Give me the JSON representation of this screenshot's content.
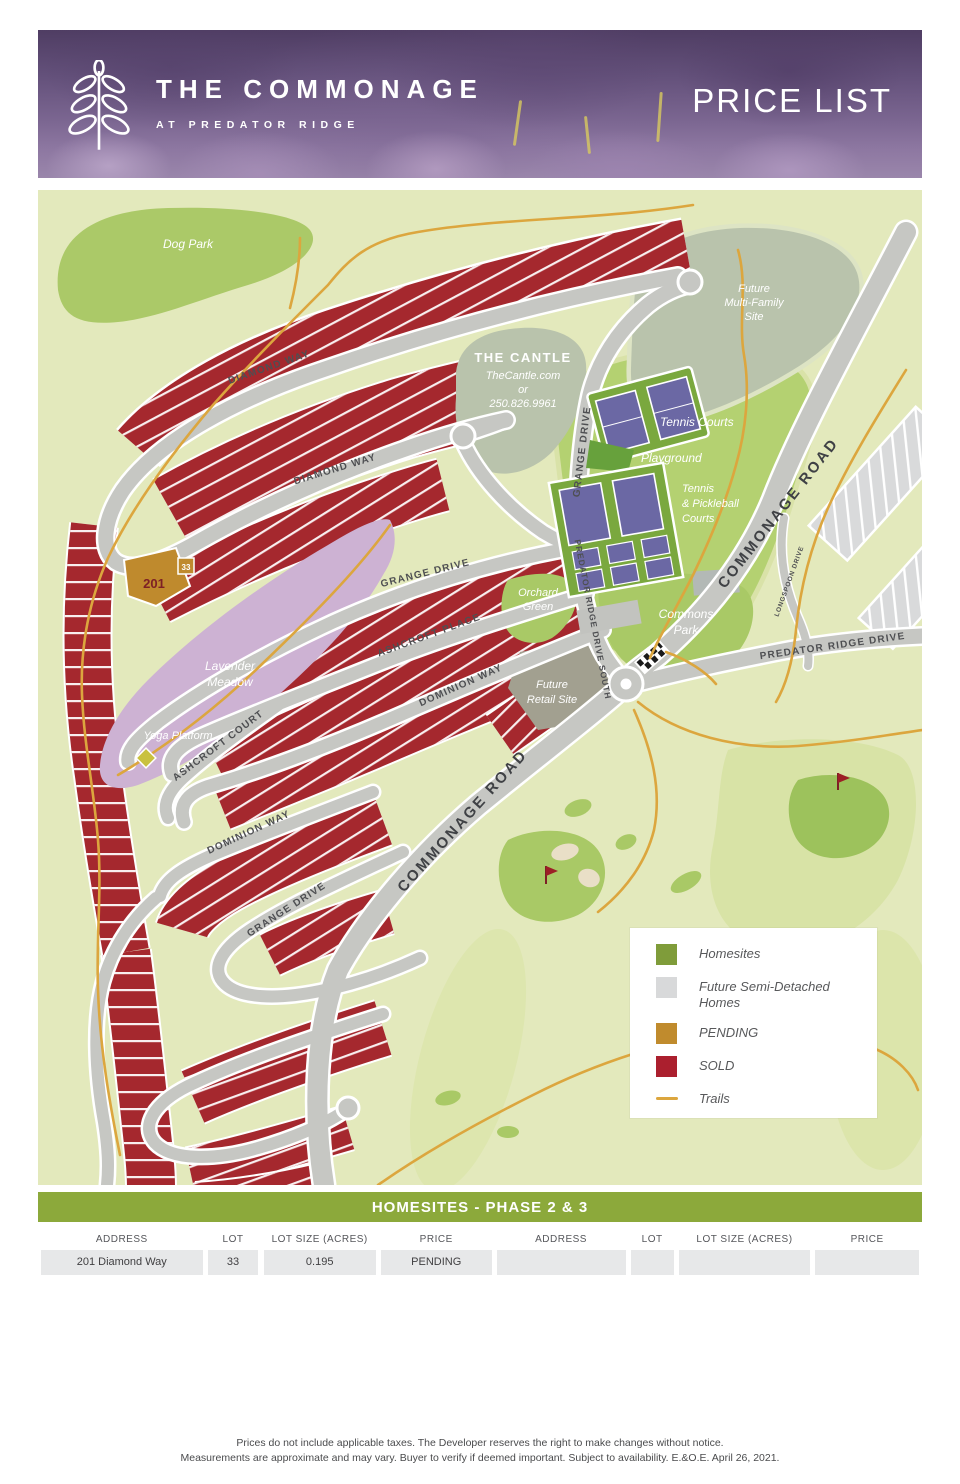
{
  "header": {
    "brand_name": "THE COMMONAGE",
    "brand_subtitle": "AT PREDATOR RIDGE",
    "page_title": "PRICE LIST"
  },
  "map": {
    "labels": {
      "dog_park": "Dog Park",
      "cantle_name": "THE CANTLE",
      "cantle_web": "TheCantle.com",
      "cantle_or": "or",
      "cantle_phone": "250.826.9961",
      "future_mf_1": "Future",
      "future_mf_2": "Multi-Family",
      "future_mf_3": "Site",
      "tennis_courts": "Tennis Courts",
      "playground": "Playground",
      "pickleball_1": "Tennis",
      "pickleball_2": "& Pickleball",
      "pickleball_3": "Courts",
      "orchard_1": "Orchard",
      "orchard_2": "Green",
      "commons_1": "Commons",
      "commons_2": "Park",
      "retail_1": "Future",
      "retail_2": "Retail Site",
      "meadow_1": "Lavender",
      "meadow_2": "Meadow",
      "yoga": "Yoga Platform",
      "lot201": "201",
      "lot201_badge": "33"
    },
    "roads": {
      "diamond_way": "DIAMOND WAY",
      "grange_drive": "GRANGE DRIVE",
      "ashcroft_place": "ASHCROFT PLACE",
      "ashcroft_court": "ASHCROFT COURT",
      "dominion_way": "DOMINION WAY",
      "predator_ridge_drive_south": "PREDATOR RIDGE DRIVE SOUTH",
      "predator_ridge_drive": "PREDATOR RIDGE DRIVE",
      "commonage_road": "COMMONAGE ROAD",
      "longspoon_drive": "LONGSPOON DRIVE"
    }
  },
  "legend": {
    "items": [
      {
        "label": "Homesites",
        "color": "#7f9c3a",
        "type": "square"
      },
      {
        "label": "Future Semi-Detached Homes",
        "color": "#d8d9da",
        "type": "square"
      },
      {
        "label": "PENDING",
        "color": "#c08b2d",
        "type": "square"
      },
      {
        "label": "SOLD",
        "color": "#ab1f2e",
        "type": "square"
      },
      {
        "label": "Trails",
        "color": "#dca63e",
        "type": "line"
      }
    ]
  },
  "table": {
    "title": "HOMESITES - PHASE 2 & 3",
    "columns": [
      "ADDRESS",
      "LOT",
      "LOT SIZE (ACRES)",
      "PRICE",
      "ADDRESS",
      "LOT",
      "LOT SIZE (ACRES)",
      "PRICE"
    ],
    "rows": [
      [
        "201 Diamond Way",
        "33",
        "0.195",
        "PENDING",
        "",
        "",
        "",
        ""
      ]
    ]
  },
  "footer": {
    "line1": "Prices do not include applicable taxes. The Developer reserves the right to make changes without notice.",
    "line2": "Measurements are approximate and may vary. Buyer to verify if deemed important. Subject to availability. E.&O.E. April 26, 2021."
  },
  "colors": {
    "map_background": "#e3e9bc",
    "park_green": "#abc968",
    "central_green": "#b4d171",
    "sage_green": "#b9c3ac",
    "road_gray": "#c6c7c3",
    "sold_red": "#a5282e",
    "pending_gold": "#bf8a2d",
    "lavender_meadow": "#cdb2d3",
    "trail_orange": "#dca63e",
    "table_header_green": "#8ca93b",
    "future_retail": "#a2a090"
  }
}
